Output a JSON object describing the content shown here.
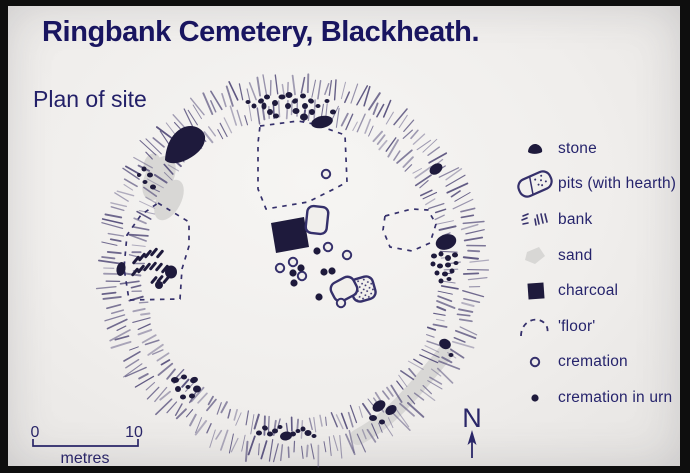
{
  "header": {
    "title": "Ringbank Cemetery, Blackheath.",
    "subtitle": "Plan of site"
  },
  "legend": {
    "items": [
      {
        "key": "stone",
        "label": "stone"
      },
      {
        "key": "pits",
        "label": "pits (with hearth)"
      },
      {
        "key": "bank",
        "label": "bank"
      },
      {
        "key": "sand",
        "label": "sand"
      },
      {
        "key": "charcoal",
        "label": "charcoal"
      },
      {
        "key": "floor",
        "label": "'floor'"
      },
      {
        "key": "cremation",
        "label": "cremation"
      },
      {
        "key": "cremation-urn",
        "label": "cremation in urn"
      }
    ]
  },
  "scale_bar": {
    "start_label": "0",
    "end_label": "10",
    "unit_label": "metres"
  },
  "compass": {
    "label": "N"
  },
  "colors": {
    "frame": "#0e0e0e",
    "paper": "#f1efec",
    "title": "#191560",
    "ink": "#35306b",
    "hachure": "#5d5680",
    "sand": "#d8d7d5",
    "dark": "#1e1a3c"
  },
  "plan": {
    "ring": {
      "cx": 284,
      "cy": 263,
      "rows": [
        {
          "r": 175,
          "len": 15,
          "count": 190
        },
        {
          "r": 151,
          "len": 13,
          "count": 168
        }
      ]
    },
    "wedge": "M157,154 C158,140 163,128 174,122 C184,117 195,122 197,130 C198,139 191,147 182,152 C172,158 161,159 157,154 Z",
    "sand": {
      "blobs": [
        [
          151,
          172,
          14,
          24,
          28
        ],
        [
          161,
          194,
          12,
          22,
          28
        ],
        [
          144,
          158,
          8,
          11,
          20
        ]
      ],
      "streak": "M350,431 C364,424 378,413 391,400 C405,386 421,367 437,347"
    },
    "floors": [
      [
        [
          252,
          120
        ],
        [
          290,
          115
        ],
        [
          306,
          118
        ],
        [
          337,
          129
        ],
        [
          339,
          176
        ],
        [
          328,
          182
        ],
        [
          300,
          196
        ],
        [
          258,
          203
        ],
        [
          250,
          183
        ],
        [
          250,
          137
        ]
      ],
      [
        [
          377,
          210
        ],
        [
          404,
          203
        ],
        [
          420,
          204
        ],
        [
          428,
          218
        ],
        [
          422,
          237
        ],
        [
          404,
          245
        ],
        [
          382,
          241
        ],
        [
          375,
          224
        ]
      ],
      [
        [
          150,
          197
        ],
        [
          181,
          216
        ],
        [
          181,
          240
        ],
        [
          174,
          263
        ],
        [
          172,
          293
        ],
        [
          121,
          294
        ],
        [
          116,
          262
        ],
        [
          119,
          229
        ],
        [
          133,
          209
        ]
      ]
    ],
    "rows": [
      [
        128,
        254,
        7,
        -50
      ],
      [
        134,
        251,
        7,
        -50
      ],
      [
        140,
        248,
        7,
        -50
      ],
      [
        146,
        246,
        7,
        -50
      ],
      [
        152,
        248,
        7,
        -50
      ],
      [
        127,
        266,
        7,
        -50
      ],
      [
        133,
        263,
        7,
        -50
      ],
      [
        139,
        261,
        7,
        -50
      ],
      [
        145,
        260,
        7,
        -50
      ],
      [
        151,
        261,
        7,
        -50
      ],
      [
        157,
        263,
        7,
        -50
      ],
      [
        146,
        274,
        6,
        -50
      ],
      [
        152,
        273,
        6,
        -50
      ],
      [
        158,
        274,
        6,
        -50
      ]
    ],
    "charcoal": [
      [
        263,
        217
      ],
      [
        296,
        211
      ],
      [
        301,
        241
      ],
      [
        268,
        247
      ]
    ],
    "pits": [
      {
        "cx": 355,
        "cy": 283,
        "w": 23,
        "h": 23,
        "rx": 7,
        "rot": -16,
        "stipple": true
      },
      {
        "cx": 336,
        "cy": 283,
        "w": 25,
        "h": 20,
        "rx": 7,
        "rot": -28,
        "stipple": false
      },
      {
        "cx": 309,
        "cy": 214,
        "w": 21,
        "h": 27,
        "rx": 6,
        "rot": 6,
        "stipple": false
      }
    ],
    "stones": [
      [
        240,
        96,
        2.5,
        2,
        0
      ],
      [
        246,
        100,
        2.5,
        2.5,
        0
      ],
      [
        253,
        95,
        3,
        2.5,
        -20
      ],
      [
        259,
        91,
        3,
        2.5,
        0
      ],
      [
        256,
        100,
        2.5,
        3.5,
        0
      ],
      [
        262,
        106,
        3,
        3,
        0
      ],
      [
        267,
        97,
        3,
        3,
        30
      ],
      [
        268,
        110,
        3,
        2.5,
        0
      ],
      [
        274,
        91,
        3.5,
        2.5,
        0
      ],
      [
        281,
        89,
        3.5,
        3,
        0
      ],
      [
        280,
        100,
        3,
        3,
        0
      ],
      [
        287,
        95,
        3,
        2.5,
        -30
      ],
      [
        288,
        105,
        3.5,
        3,
        0
      ],
      [
        295,
        90,
        3,
        2.5,
        0
      ],
      [
        297,
        100,
        3,
        3,
        0
      ],
      [
        303,
        95,
        3,
        2.5,
        20
      ],
      [
        296,
        111,
        4,
        3.5,
        0
      ],
      [
        304,
        106,
        3,
        3,
        0
      ],
      [
        310,
        100,
        2.5,
        2,
        0
      ],
      [
        314,
        116,
        11,
        6,
        -12
      ],
      [
        325,
        106,
        3,
        2.5,
        0
      ],
      [
        319,
        95,
        2.5,
        2,
        0
      ],
      [
        136,
        163,
        2.5,
        2.5,
        0
      ],
      [
        142,
        169,
        3,
        2.5,
        0
      ],
      [
        137,
        176,
        2.5,
        2,
        0
      ],
      [
        145,
        181,
        3,
        2.5,
        0
      ],
      [
        131,
        169,
        2,
        2,
        0
      ],
      [
        113,
        263,
        4.5,
        7,
        10
      ],
      [
        163,
        266,
        6,
        6.5,
        0
      ],
      [
        151,
        279,
        4,
        4,
        0
      ],
      [
        428,
        163,
        7,
        5,
        -35
      ],
      [
        438,
        236,
        10.5,
        7.5,
        -18
      ],
      [
        426,
        250,
        3,
        2.5,
        0
      ],
      [
        433,
        248,
        2.5,
        2.5,
        0
      ],
      [
        440,
        252,
        3,
        3,
        0
      ],
      [
        447,
        249,
        3,
        2.5,
        0
      ],
      [
        425,
        258,
        2.5,
        2.5,
        0
      ],
      [
        432,
        260,
        3,
        2.5,
        0
      ],
      [
        440,
        259,
        3,
        2.5,
        0
      ],
      [
        448,
        257,
        2.5,
        2,
        0
      ],
      [
        429,
        267,
        2.5,
        2.5,
        0
      ],
      [
        437,
        268,
        3,
        2.5,
        0
      ],
      [
        444,
        265,
        2.5,
        2.5,
        0
      ],
      [
        433,
        275,
        2.5,
        2.5,
        0
      ],
      [
        441,
        273,
        2.5,
        2,
        0
      ],
      [
        437,
        338,
        6,
        5,
        25
      ],
      [
        443,
        349,
        2.5,
        2,
        0
      ],
      [
        371,
        400,
        7,
        5,
        -35
      ],
      [
        383,
        404,
        6,
        4.5,
        -35
      ],
      [
        365,
        412,
        4,
        3,
        0
      ],
      [
        374,
        416,
        3,
        2.5,
        0
      ],
      [
        251,
        427,
        3,
        2.5,
        0
      ],
      [
        257,
        422,
        3,
        2.5,
        20
      ],
      [
        262,
        428,
        3,
        2.5,
        0
      ],
      [
        267,
        425,
        3,
        2.5,
        0
      ],
      [
        272,
        421,
        2.5,
        2,
        0
      ],
      [
        278,
        430,
        6,
        4.5,
        -10
      ],
      [
        285,
        428,
        3,
        2.5,
        0
      ],
      [
        290,
        425,
        2.5,
        2,
        0
      ],
      [
        295,
        423,
        2.5,
        2.5,
        0
      ],
      [
        300,
        427,
        3.5,
        3,
        0
      ],
      [
        306,
        430,
        2.5,
        2,
        0
      ],
      [
        167,
        374,
        4,
        3,
        0
      ],
      [
        176,
        371,
        3,
        2.5,
        0
      ],
      [
        186,
        374,
        4,
        3,
        -20
      ],
      [
        170,
        383,
        3,
        3,
        0
      ],
      [
        180,
        381,
        2.5,
        2,
        0
      ],
      [
        189,
        383,
        4,
        3.5,
        0
      ],
      [
        175,
        391,
        3,
        2.5,
        0
      ],
      [
        184,
        390,
        3,
        2.5,
        0
      ]
    ],
    "cremations_open": [
      [
        320,
        241
      ],
      [
        339,
        249
      ],
      [
        285,
        256
      ],
      [
        272,
        262
      ],
      [
        294,
        270
      ],
      [
        333,
        297
      ],
      [
        318,
        168
      ]
    ],
    "cremations_urn": [
      [
        309,
        245
      ],
      [
        293,
        262
      ],
      [
        285,
        267
      ],
      [
        286,
        277
      ],
      [
        316,
        266
      ],
      [
        324,
        265
      ],
      [
        311,
        291
      ]
    ]
  }
}
